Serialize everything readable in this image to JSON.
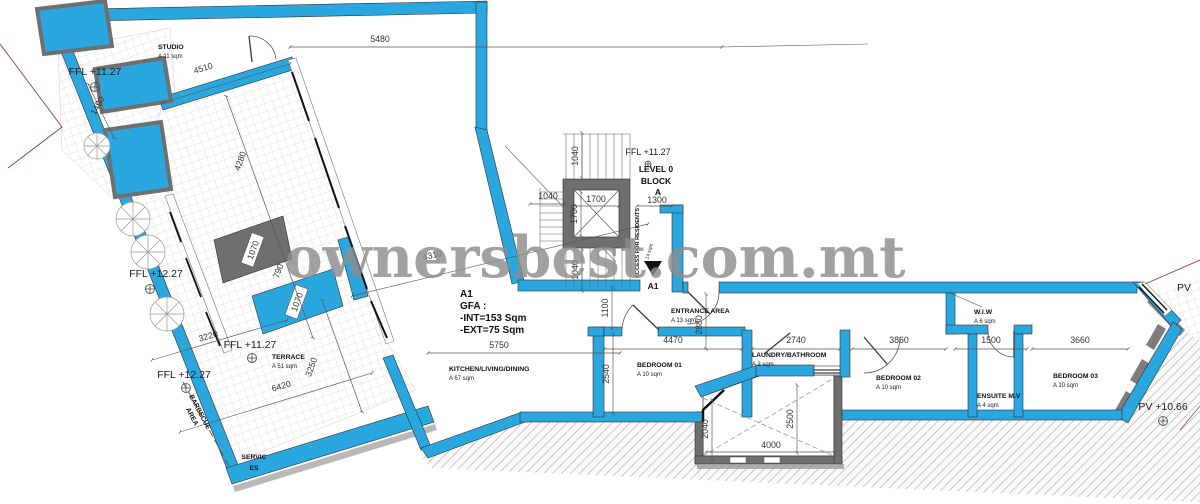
{
  "watermark": "ownersbest.com.mt",
  "gfa": {
    "unit": "A1",
    "label": "GFA :",
    "int": "-INT=153 Sqm",
    "ext": "-EXT=75 Sqm"
  },
  "core": {
    "level1": "LEVEL 0",
    "level2": "BLOCK",
    "level3": "A",
    "access": "ACCESS FOR RESIDENTS",
    "access_area": "A 14 sqm",
    "section": "A1"
  },
  "rooms": {
    "studio": {
      "n": "STUDIO",
      "a": "A 11 sqm"
    },
    "terrace": {
      "n": "TERRACE",
      "a": "A 51 sqm"
    },
    "barbecue": {
      "n1": "BARBECUE",
      "n2": "AREA"
    },
    "services": {
      "n1": "SERVIC",
      "n2": "ES"
    },
    "kitchen": {
      "n": "KITCHEN/LIVING/DINING",
      "a": "A 67 sqm"
    },
    "entrance": {
      "n": "ENTRANCE AREA",
      "a": "A 13 sqm"
    },
    "bedroom1": {
      "n": "BEDROOM 01",
      "a": "A 10 sqm"
    },
    "laundry": {
      "n": "LAUNDRY/BATHROOM",
      "a": "A 3 sqm"
    },
    "bedroom2": {
      "n": "BEDROOM 02",
      "a": "A 10 sqm"
    },
    "wiw": {
      "n": "W.I.W",
      "a": "A 6 sqm"
    },
    "ensuite": {
      "n": "ENSUITE M.V",
      "a": "A 4 sqm"
    },
    "bedroom3": {
      "n": "BEDROOM 03",
      "a": "A 10 sqm"
    }
  },
  "levels": {
    "ffl_studio": "FFL +11.27",
    "ffl_left": "FFL +12.27",
    "ffl_terrace": "FFL +11.27",
    "ffl_bbq": "FFL +12.27",
    "ffl_core": "FFL +11.27",
    "pv": "PV",
    "pv_yard": "PV +10.66"
  },
  "dims": {
    "w5480": "5480",
    "w4510": "4510",
    "w1490": "1490",
    "w4280": "4280",
    "w790": "790",
    "box1": "1070",
    "box2": "1070",
    "w3220": "3220",
    "w6420": "6420",
    "w3250": "3250",
    "w4310": "4310",
    "w5750": "5750",
    "w1100": "1100",
    "w2540": "2540",
    "s1040t": "1040",
    "s1040l": "1040",
    "s1700h": "1700",
    "s1700v": "1700",
    "s1040b": "1040",
    "s1300": "1300",
    "w4470": "4470",
    "w2880": "2880",
    "w2740": "2740",
    "w3860": "3860",
    "w1500": "1500",
    "w3660": "3660",
    "w2040": "2040",
    "w2500": "2500",
    "w4000": "4000"
  },
  "colors": {
    "wall_blue": "#2ba7e0",
    "structure_gray": "#6f6f6f",
    "watermark_gray": "#8d8d8d"
  }
}
